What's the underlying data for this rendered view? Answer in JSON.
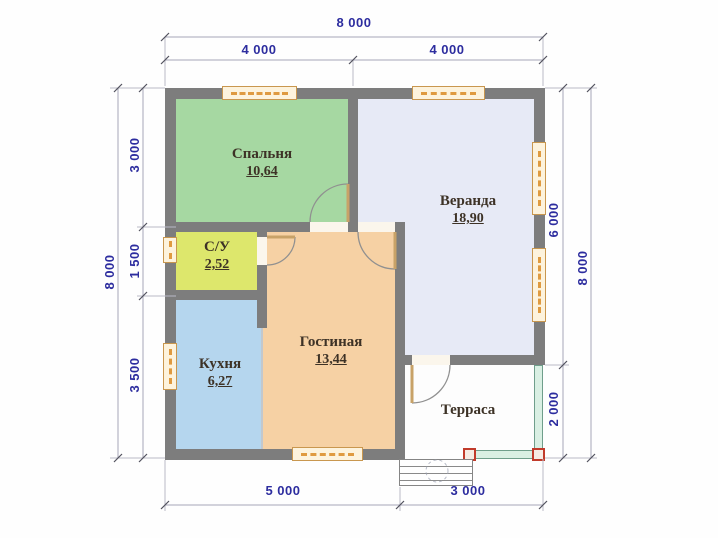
{
  "plan": {
    "rooms": {
      "bedroom": {
        "label": "Спальня",
        "area": "10,64",
        "fill": "#a6d8a2"
      },
      "veranda": {
        "label": "Веранда",
        "area": "18,90",
        "fill": "#e7eaf6"
      },
      "bathroom": {
        "label": "С/У",
        "area": "2,52",
        "fill": "#dde76c"
      },
      "kitchen": {
        "label": "Кухня",
        "area": "6,27",
        "fill": "#b5d6ee"
      },
      "living": {
        "label": "Гостиная",
        "area": "13,44",
        "fill": "#f6d1a4"
      },
      "terrace": {
        "label": "Терраса",
        "fill": "#fdfdfd"
      }
    },
    "dimensions": {
      "top_total": "8 000",
      "top_left": "4 000",
      "top_right": "4 000",
      "left_total": "8 000",
      "left_seg1": "3 000",
      "left_seg2": "1 500",
      "left_seg3": "3 500",
      "right_seg1": "6 000",
      "right_seg2": "2 000",
      "right_total": "8 000",
      "bottom_left": "5 000",
      "bottom_right": "3 000"
    },
    "colors": {
      "wall": "#7d7d7d",
      "dimension_text": "#2d2d9f",
      "window_frame": "#df9a40",
      "railing_fill": "#d9efe3",
      "railing_post_border": "#c13b2b",
      "room_label_text": "#3d3226"
    }
  }
}
